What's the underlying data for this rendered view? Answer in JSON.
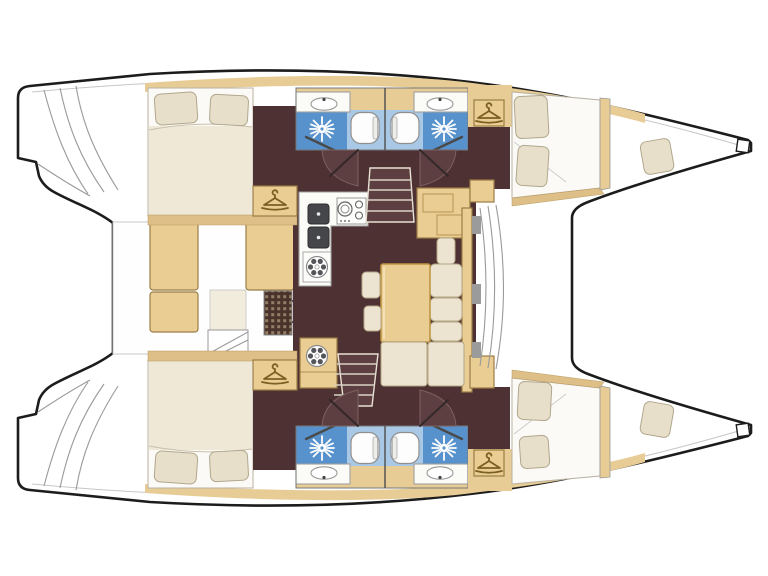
{
  "diagram": {
    "type": "boat-floorplan",
    "subject": "catamaran interior layout, top view, bows to the right",
    "visible_text": []
  },
  "colors": {
    "background": "#ffffff",
    "hull_outline": "#1c1c1c",
    "thin_line": "#9a9a9a",
    "wood_band": "#e8cc95",
    "wood_band_dark": "#ddbf87",
    "wood_furniture": "#eacd92",
    "wood_border": "#9a7c45",
    "floor_brown": "#4e3133",
    "floor_brown_light": "#5d3f41",
    "bed_white": "#fbfaf6",
    "duvet_cream": "#f0e8d6",
    "pillow_cream": "#e8dfca",
    "pillow_border": "#b1a78e",
    "cushion_cream": "#ece4d0",
    "cushion_border": "#b3a685",
    "bath_blue": "#5792cc",
    "bath_blue_light": "#a9c8e6",
    "fixture_white": "#fdfdfd",
    "fixture_border": "#8f8f8f",
    "sink_dark": "#45464a",
    "hatch_grid": "#4a332b",
    "hatch_dot": "#937d66",
    "hanger_icon": "#7c5f22",
    "counter_white": "#fbfbf8",
    "step_tread": "#d8d2c6",
    "mullion_gray": "#9b9b9b"
  },
  "icons": {
    "wardrobe": "hanger-icon",
    "shower": "sunburst-spray-icon",
    "toilet": "toilet-bowl-icon",
    "washbasin": "half-round-sink-icon",
    "galley_sink": "square-sink-icon",
    "stove": "burner-hob-icon",
    "vent": "round-vent-wheel-icon",
    "stairs": "companionway-steps-icon",
    "door": "quarter-circle-swing-icon",
    "engine_hatch": "grating-grid-icon"
  },
  "rooms": [
    "port-aft-cabin",
    "port-aft-head",
    "port-fore-head",
    "port-fore-cabin",
    "port-forepeak",
    "starboard-aft-cabin",
    "starboard-aft-head",
    "starboard-fore-head",
    "starboard-fore-cabin",
    "starboard-forepeak",
    "salon",
    "galley",
    "dinette",
    "cockpit",
    "foredeck"
  ]
}
